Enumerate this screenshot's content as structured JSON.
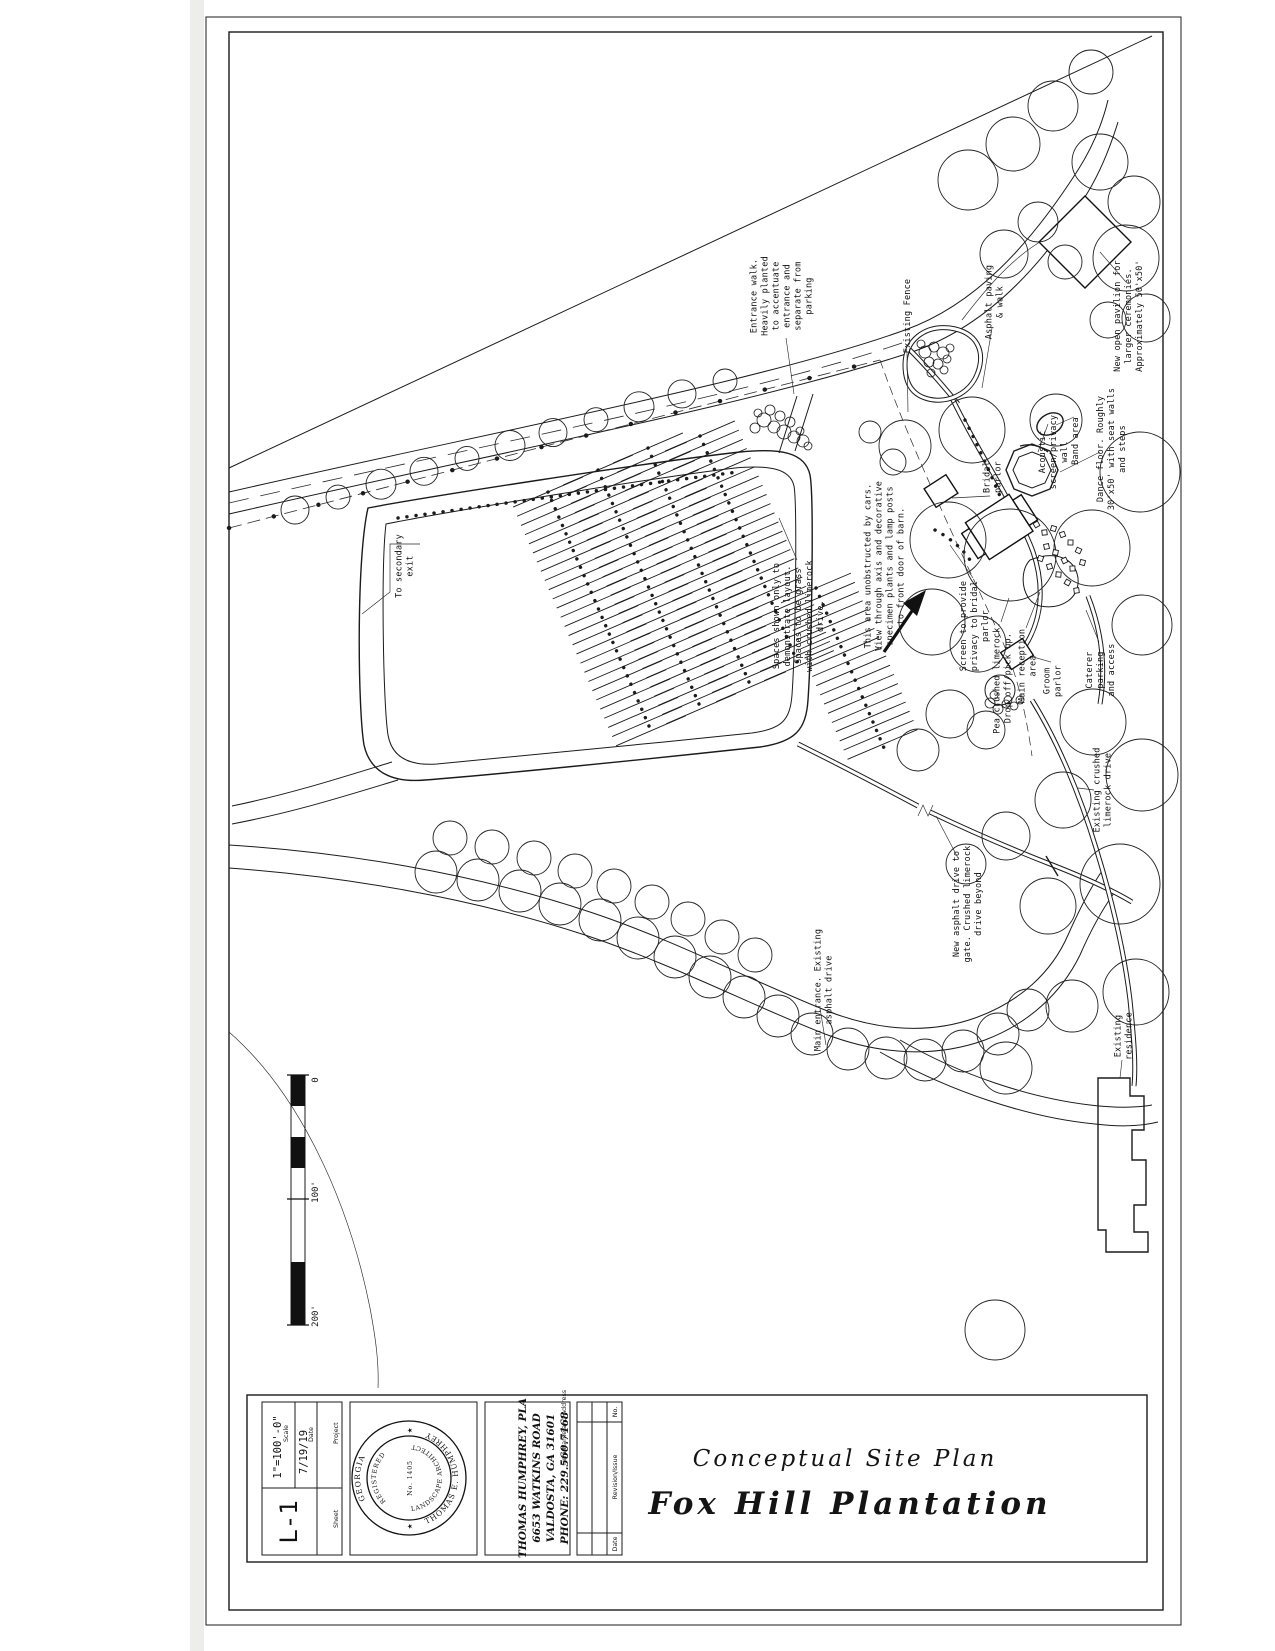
{
  "title_block": {
    "subtitle": "Conceptual Site Plan",
    "title": "Fox Hill Plantation",
    "fields": {
      "project_label": "Project",
      "sheet_label": "Sheet",
      "date_label": "Date",
      "date_value": "7/19/19",
      "scale_label": "Scale",
      "scale_value": "1\"=100'-0\"",
      "sheet_value": "L-1"
    },
    "firm": {
      "label": "Firm Name and Address",
      "lines": [
        "THOMAS HUMPHREY, PLA",
        "6653 WATKINS ROAD",
        "VALDOSTA, GA 31601",
        "PHONE: 229.560.7168"
      ]
    },
    "revisions": {
      "no_label": "No.",
      "revision_label": "Revision/Issue",
      "date_label": "Date"
    },
    "seal": {
      "region": "GEORGIA",
      "registered": "REGISTERED",
      "name": "THOMAS E. HUMPHREY",
      "profession": "LANDSCAPE ARCHITECT",
      "number": "No. 1405",
      "star": "★"
    }
  },
  "scale_bar": {
    "zero": "0",
    "mid": "100'",
    "end": "200'"
  },
  "plan": {
    "labels": [
      {
        "id": "existing-fence",
        "lines": [
          "Existing Fence"
        ]
      },
      {
        "id": "asphalt-paving",
        "lines": [
          "Asphalt paving",
          "& walk"
        ]
      },
      {
        "id": "new-pavilion",
        "lines": [
          "New open pavilion for",
          "larger ceremonies.",
          "Approximately 50'x50'"
        ]
      },
      {
        "id": "entrance-walk",
        "lines": [
          "Entrance walk.",
          "Heavily planted",
          "to accentuate",
          "entrance and",
          "separate from",
          "parking"
        ]
      },
      {
        "id": "dance-floor",
        "lines": [
          "Dance floor. Roughly",
          "30'x50' with seat walls",
          "and steps"
        ]
      },
      {
        "id": "band-area",
        "lines": [
          "Band area"
        ]
      },
      {
        "id": "acoustic-screen",
        "lines": [
          "Acoustic",
          "screen/privacy",
          "wall"
        ]
      },
      {
        "id": "bridal-parlor",
        "lines": [
          "Bridal",
          "parlor"
        ]
      },
      {
        "id": "secondary-exit",
        "lines": [
          "To secondary",
          "exit"
        ]
      },
      {
        "id": "axis-note",
        "lines": [
          "This area unobstructed by cars.",
          "View through axis and decorative",
          "specimen plants and lamp posts",
          "to front door of barn."
        ]
      },
      {
        "id": "spaces-note",
        "lines": [
          "Spaces shown only to",
          "demonstrate layout.",
          "Spaces to be grass",
          "with crushed limerock",
          "drive."
        ]
      },
      {
        "id": "privacy-screen",
        "lines": [
          "Screen to provide",
          "privacy to bridal",
          "parlor"
        ]
      },
      {
        "id": "drop-off",
        "lines": [
          "Pea crushed limerock.",
          "Drop off/pick up."
        ]
      },
      {
        "id": "main-reception",
        "lines": [
          "Main reception",
          "area"
        ]
      },
      {
        "id": "groom-parlor",
        "lines": [
          "Groom",
          "parlor"
        ]
      },
      {
        "id": "caterer",
        "lines": [
          "Caterer",
          "parking",
          "and access"
        ]
      },
      {
        "id": "limerock-drive",
        "lines": [
          "Existing crushed",
          "limerock drive"
        ]
      },
      {
        "id": "new-asphalt",
        "lines": [
          "New asphalt drive to",
          "gate. Crushed limerock",
          "drive beyond"
        ]
      },
      {
        "id": "main-entrance",
        "lines": [
          "Main entrance. Existing",
          "asphalt drive"
        ]
      },
      {
        "id": "residence",
        "lines": [
          "Existing",
          "residence"
        ]
      }
    ]
  }
}
